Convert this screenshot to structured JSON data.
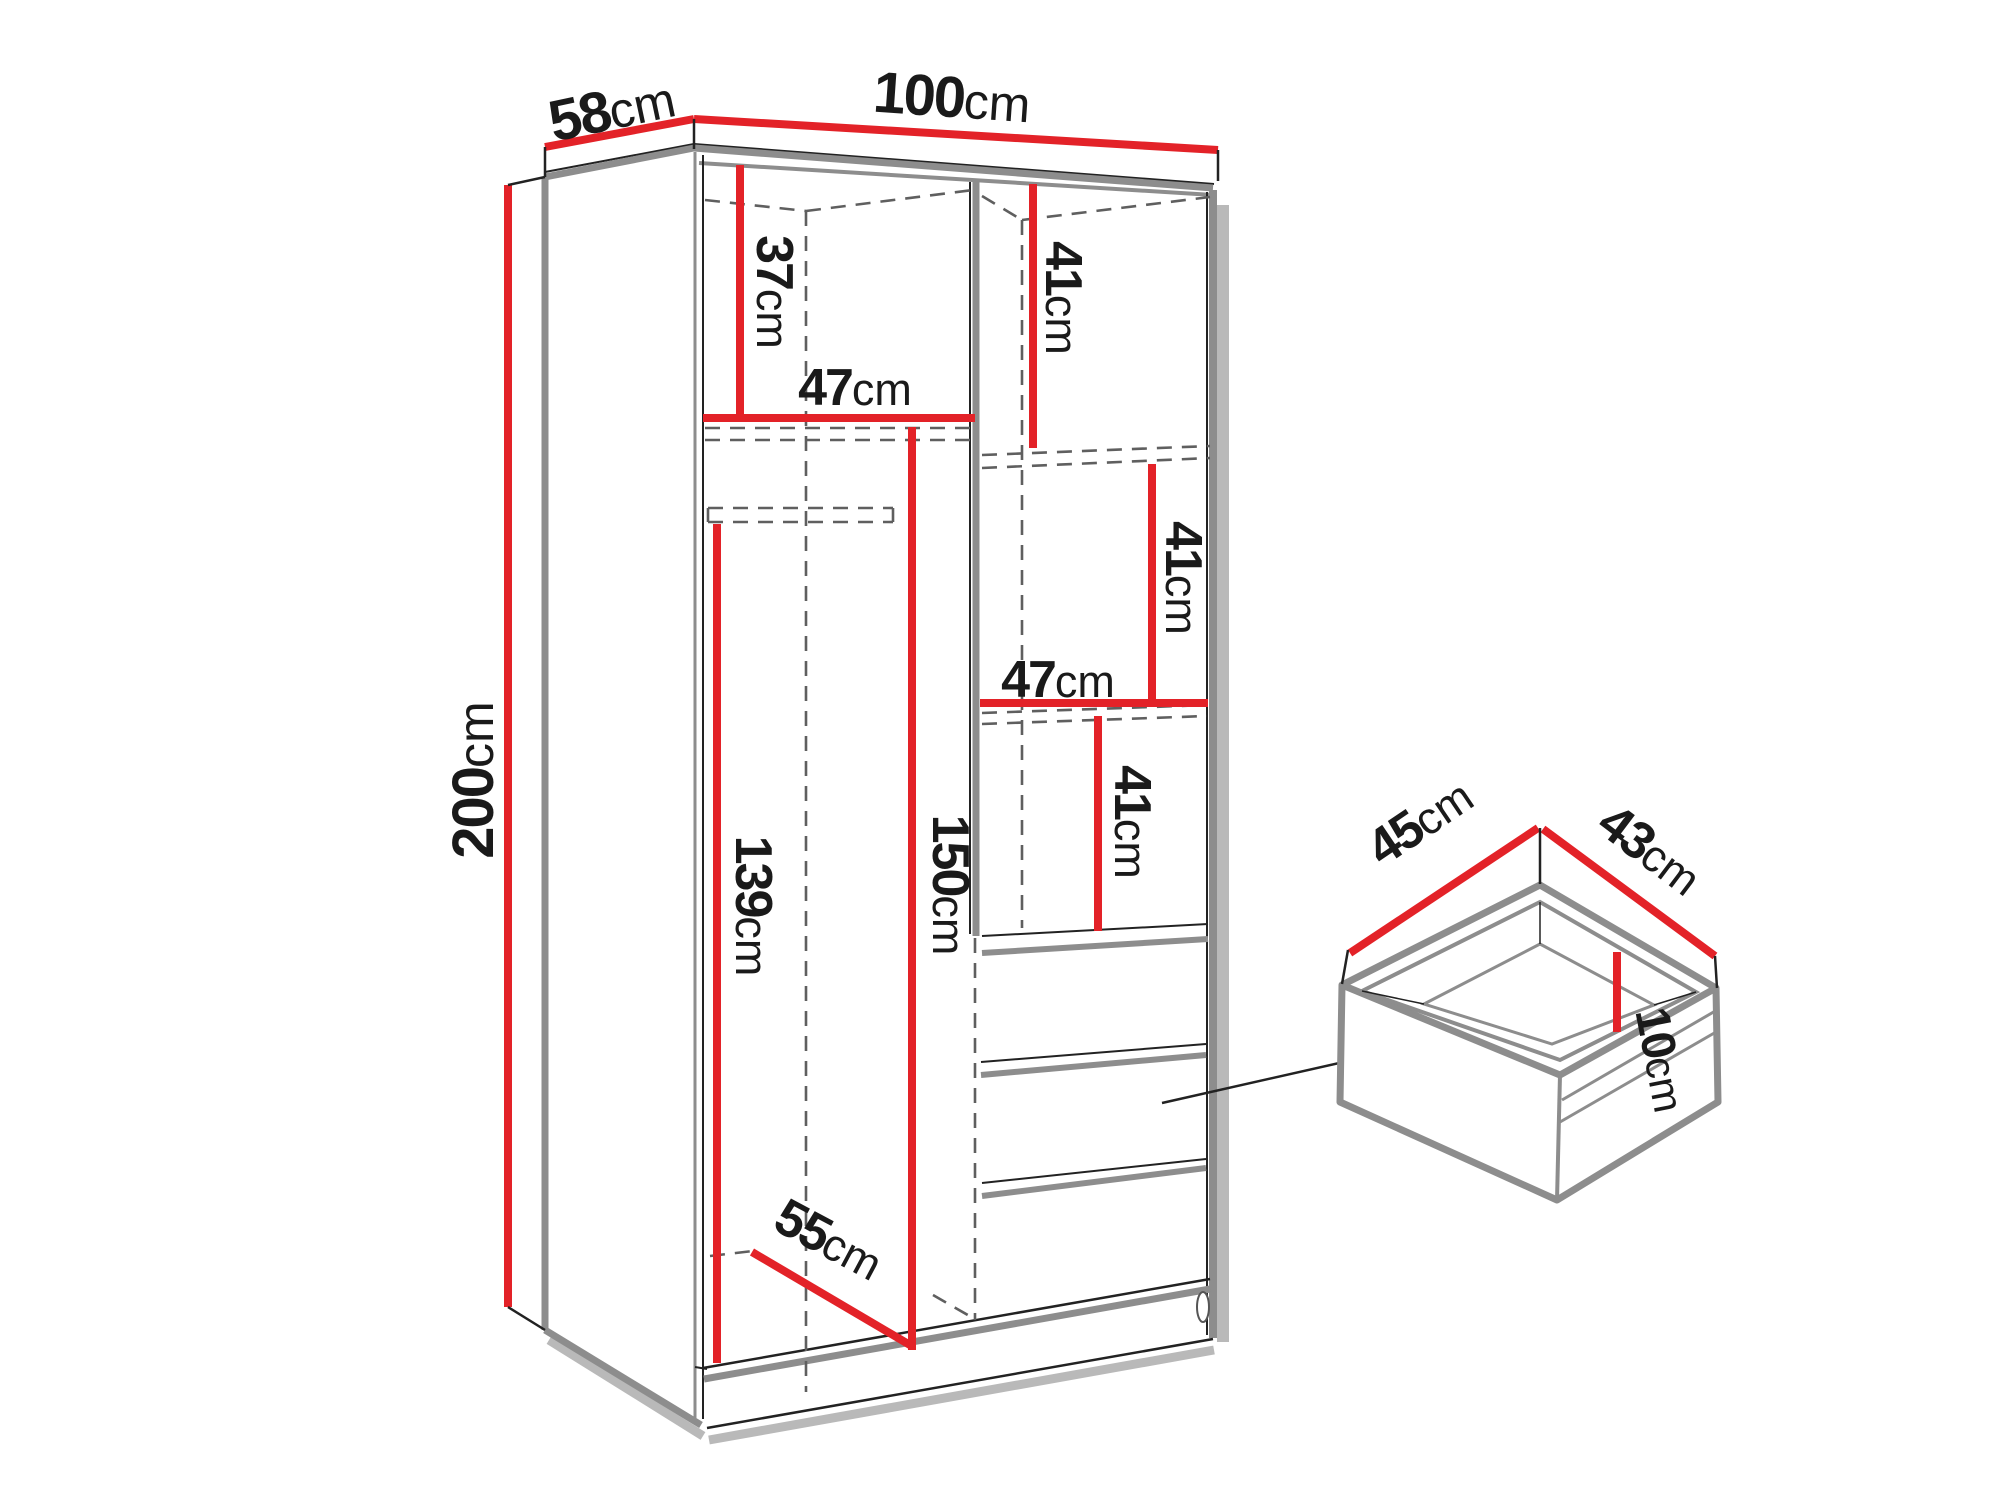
{
  "colors": {
    "red": "#e32228",
    "gray": "#8d8d8d",
    "line": "#222222",
    "dash": "#5f5f5f",
    "shadow": "#b9b9b9"
  },
  "wardrobe": {
    "depth": {
      "value": "58",
      "unit": "cm"
    },
    "width": {
      "value": "100",
      "unit": "cm"
    },
    "height": {
      "value": "200",
      "unit": "cm"
    },
    "top_section_height": {
      "value": "37",
      "unit": "cm"
    },
    "left_shelf_width": {
      "value": "47",
      "unit": "cm"
    },
    "right_top_height": {
      "value": "41",
      "unit": "cm"
    },
    "right_mid_height": {
      "value": "41",
      "unit": "cm"
    },
    "right_shelf_width": {
      "value": "47",
      "unit": "cm"
    },
    "right_low_height": {
      "value": "41",
      "unit": "cm"
    },
    "hanging_height": {
      "value": "150",
      "unit": "cm"
    },
    "left_hang_height": {
      "value": "139",
      "unit": "cm"
    },
    "interior_depth": {
      "value": "55",
      "unit": "cm"
    }
  },
  "drawer": {
    "depth": {
      "value": "45",
      "unit": "cm"
    },
    "width": {
      "value": "43",
      "unit": "cm"
    },
    "height": {
      "value": "10",
      "unit": "cm"
    }
  }
}
